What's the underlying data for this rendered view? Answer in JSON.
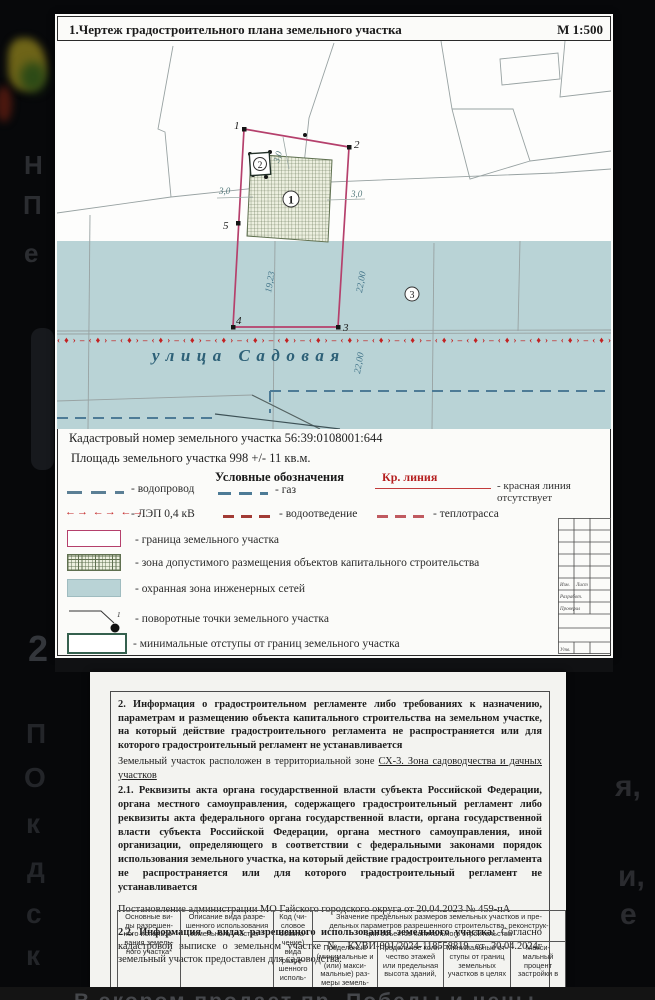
{
  "page1": {
    "title": "1.Чертеж градостроительного плана земельного участка",
    "scale": "М 1:500",
    "cadastral_number_line": "Кадастровый номер земельного участка 56:39:0108001:644",
    "area_line": "Площадь земельного участка 998 +/- 11 кв.м.",
    "map": {
      "street_name": "улица Садовая",
      "dim_left": "19,23",
      "dim_right_upper": "22,00",
      "dim_right_lower": "22,00",
      "offset_left": "3,0",
      "offset_right": "3,0",
      "offset_top": "3,0",
      "pt1": "1",
      "pt2": "2",
      "pt3": "3",
      "pt4": "4",
      "pt5": "5",
      "zone1": "1",
      "zone2": "2",
      "zone3": "3",
      "lep_pattern": "‹♦›–‹♦›–‹♦›–‹♦›–‹♦›–‹♦›–‹♦›–‹♦›–‹♦›–‹♦›–‹♦›–‹♦›–‹♦›–‹♦›–‹♦›–‹♦›–‹♦›–‹♦›"
    },
    "legend": {
      "header": "Условные обозначения",
      "kr_label": "Кр. линия",
      "kr_desc": "- красная линия отсутствует",
      "vodoprovod": "- водопровод",
      "gaz": "- газ",
      "lep": "- ЛЭП 0,4 кВ",
      "lep_symbol": "←→ ←→ ←→",
      "vodootvedenie": "- водоотведение",
      "teplotrassa": "- теплотрасса",
      "granica": "- граница земельного участка",
      "zona_dopustimogo": "- зона допустимого размещения объектов капитального строительства",
      "ohrannaya": "- охранная зона инженерных сетей",
      "povorotnye": "- поворотные точки земельного участка",
      "min_otstupy": "- минимальные отступы от границ земельного участка",
      "povorot_num": "1"
    },
    "stamp": {
      "izm": "Изм.",
      "list": "Лист",
      "razrabot": "Разработ.",
      "proveril": "Проверил",
      "utv": "Утв."
    },
    "colors": {
      "boundary_pink": "#b5406c",
      "hatch_green": "#5f7050",
      "protection_blue": "#b9d3d6",
      "lep_red": "#c22222",
      "water_blue": "#4d7b96",
      "min_offset_green": "#35604e"
    }
  },
  "page2": {
    "para2_bold": "2. Информация о градостроительном регламенте либо требованиях к назначению, параметрам и размещению объекта капитального строительства на земельном участке, на который действие градостроительного регламента не распространяется или для которого градостроительный регламент не устанавливается",
    "para2_plain": "Земельный участок расположен в территориальной зоне ",
    "para2_zone": "СХ-3.  Зона садоводчества и дачных участков",
    "para21_bold": "2.1. Реквизиты акта органа государственной власти субъекта Российской Федерации, органа местного самоуправления, содержащего градостроительный регламент либо реквизиты акта федерального органа государственной власти, органа государственной власти субъекта Российской Федерации, органа местного самоуправления, иной организации, определяющего в соответствии с федеральными законами порядок использования земельного участка, на который действие градостроительного регламента не распространяется или для которого градостроительный регламент не устанавливается",
    "para_post": "Постановление администрации МО Гайского городского округа от 20.04.2023 № 459-пА",
    "para22_bold": "2.2. Информация о видах разрешенного использования земельного участка: ",
    "para22_plain": "Согласно кадастровой выписке о земельном участке № КУВИ-001/2024-118558819 от 30.04.2024г земельный участок предоставлен для садоводства.",
    "table": {
      "col1": "Основные ви-\nды разрешен-\nного использо-\nвания земель-\nного участка*",
      "col2": "Описание вида разре-\nшенного использования\nземельного участка**",
      "col3": "Код (чи-\nсловое\nобозна-\nчение)\nвида\nразре-\nшенного\nисполь-",
      "group": "Значение предельных размеров земельных участков и пре-\nдельных параметров разрешенного строительства, реконструк-\nции объектов капитального строительства",
      "sub1": "Предельные\n(минимальные и\n(или) макси-\nмальные) раз-\nмеры земель-",
      "sub2": "Предельное коли-\nчество этажей\nили предельная\nвысота зданий,",
      "sub3": "Минимальные от-\nступы от границ\nземельных\nучастков в целях",
      "sub4": "Макси-\nмальный\nпроцент\nзастройки в"
    }
  },
  "background": {
    "left_letters": {
      "l1": "Н",
      "l2": "П",
      "l3": "е"
    },
    "left_letters2": {
      "l1": "2",
      "l2": "П",
      "l3": "О",
      "l4": "к",
      "l5": "д",
      "l6": "с",
      "l7": "к"
    },
    "right_letters": {
      "l1": "я,",
      "l2": "и,",
      "l3": "е"
    },
    "bottom_text": "В экором продает пр. Победы и цены"
  }
}
